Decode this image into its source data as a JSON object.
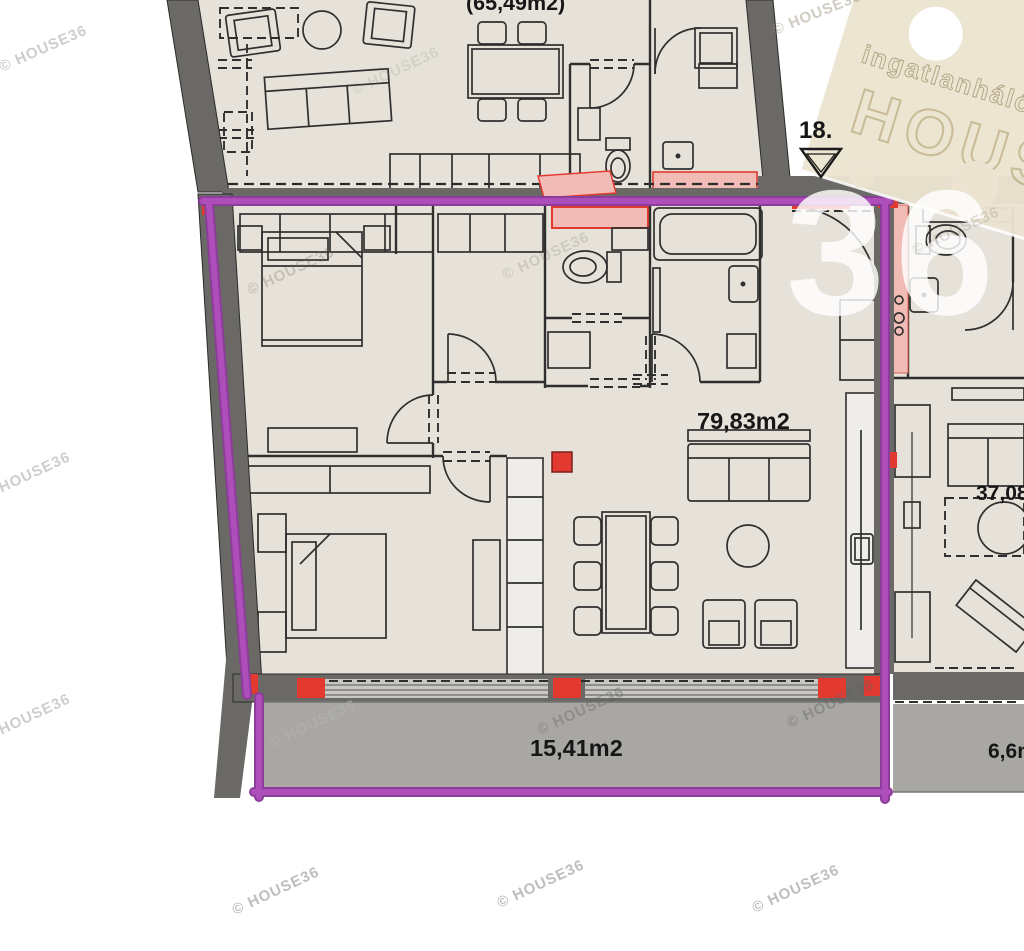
{
  "labels": {
    "upper_apartment_area": "(65,49m2)",
    "unit_number": "18.",
    "main_apartment_area": "79,83m2",
    "main_balcony_area": "15,41m2",
    "right_apartment_area": "37,08m2",
    "right_balcony_area": "6,6m2"
  },
  "watermark": {
    "text": "© HOUSE36"
  },
  "logo": {
    "network_text": "ingatlanhálózat",
    "brand_text": "HOUSE",
    "number_text": "36"
  },
  "colors": {
    "outline_purple": "#ae4eba",
    "outline_purple_dark": "#8c3d99",
    "accent_red": "#e23a30",
    "accent_red_soft": "#f2bcb6",
    "floor_beige": "#e6e2d9",
    "balcony_gray": "#a9a7a4",
    "wall_dark": "#6b6966",
    "logo_cream": "#ece4d1"
  }
}
